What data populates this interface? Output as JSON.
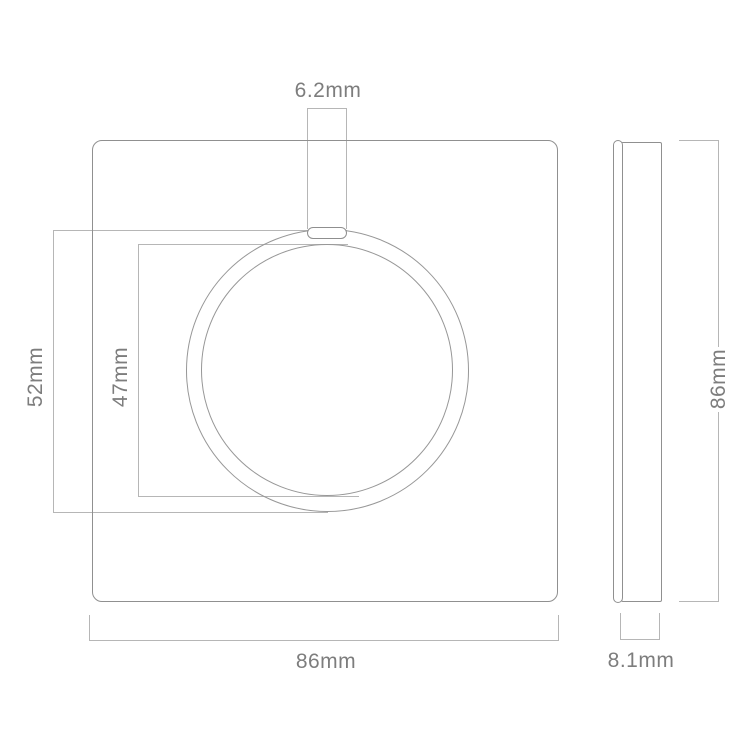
{
  "diagram": {
    "type": "product-dimension-drawing",
    "subject": "round touch wall switch plate, front and side views",
    "front_view": {
      "notch_width_label": "6.2mm",
      "outer_ring_diameter_label": "52mm",
      "inner_circle_diameter_label": "47mm",
      "plate_width_label": "86mm"
    },
    "side_view": {
      "height_label": "86mm",
      "thickness_label": "8.1mm"
    },
    "colors": {
      "background": "#ffffff",
      "object_outline": "#909090",
      "circle_outline": "#979797",
      "dimension_line": "#b6b6b6",
      "label_text": "#7d7d7d"
    }
  }
}
